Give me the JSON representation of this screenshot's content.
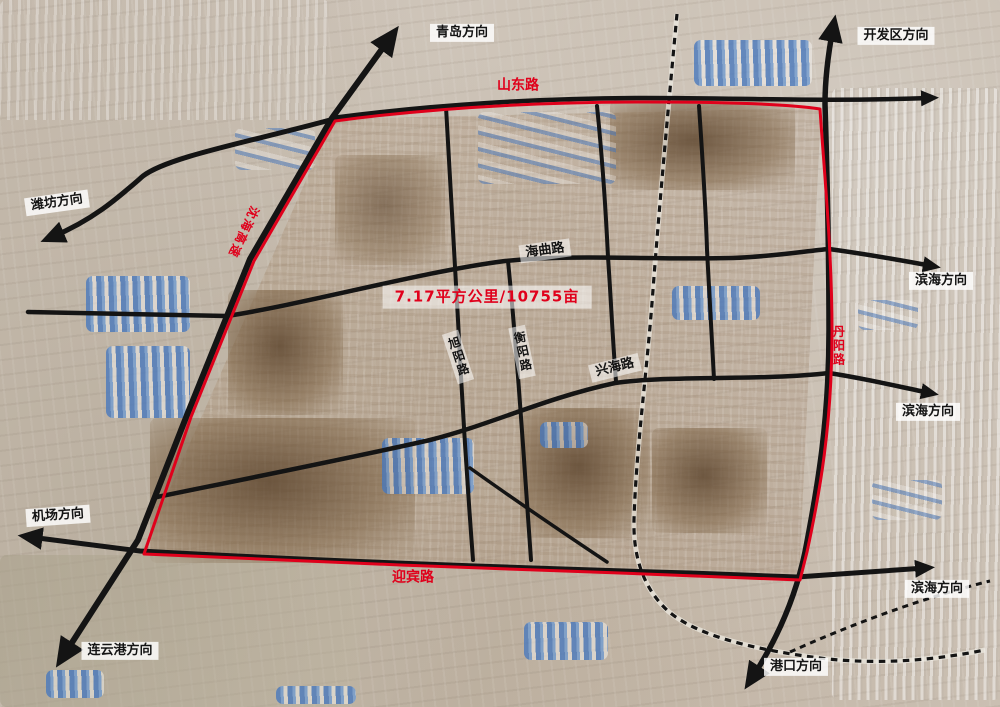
{
  "colors": {
    "boundary_red": "#e0001b",
    "road_black": "#141414"
  },
  "labels": {
    "qingdao": "青岛方向",
    "kaifaqu": "开发区方向",
    "weifang": "潍坊方向",
    "binhai_top": "滨海方向",
    "binhai_mid": "滨海方向",
    "binhai_bottom": "滨海方向",
    "jichang": "机场方向",
    "lianyungang": "连云港方向",
    "gangkou": "港口方向",
    "shandong_rd": "山东路",
    "haiqu_rd": "海曲路",
    "xuyang_rd": "旭阳路",
    "hengyang_rd": "衡阳路",
    "xinghai_rd": "兴海路",
    "danyang_rd": "丹阳路",
    "yingbin_rd": "迎宾路",
    "shenhai_expwy": "沈海高速",
    "area_stat": "7.17平方公里/10755亩"
  }
}
